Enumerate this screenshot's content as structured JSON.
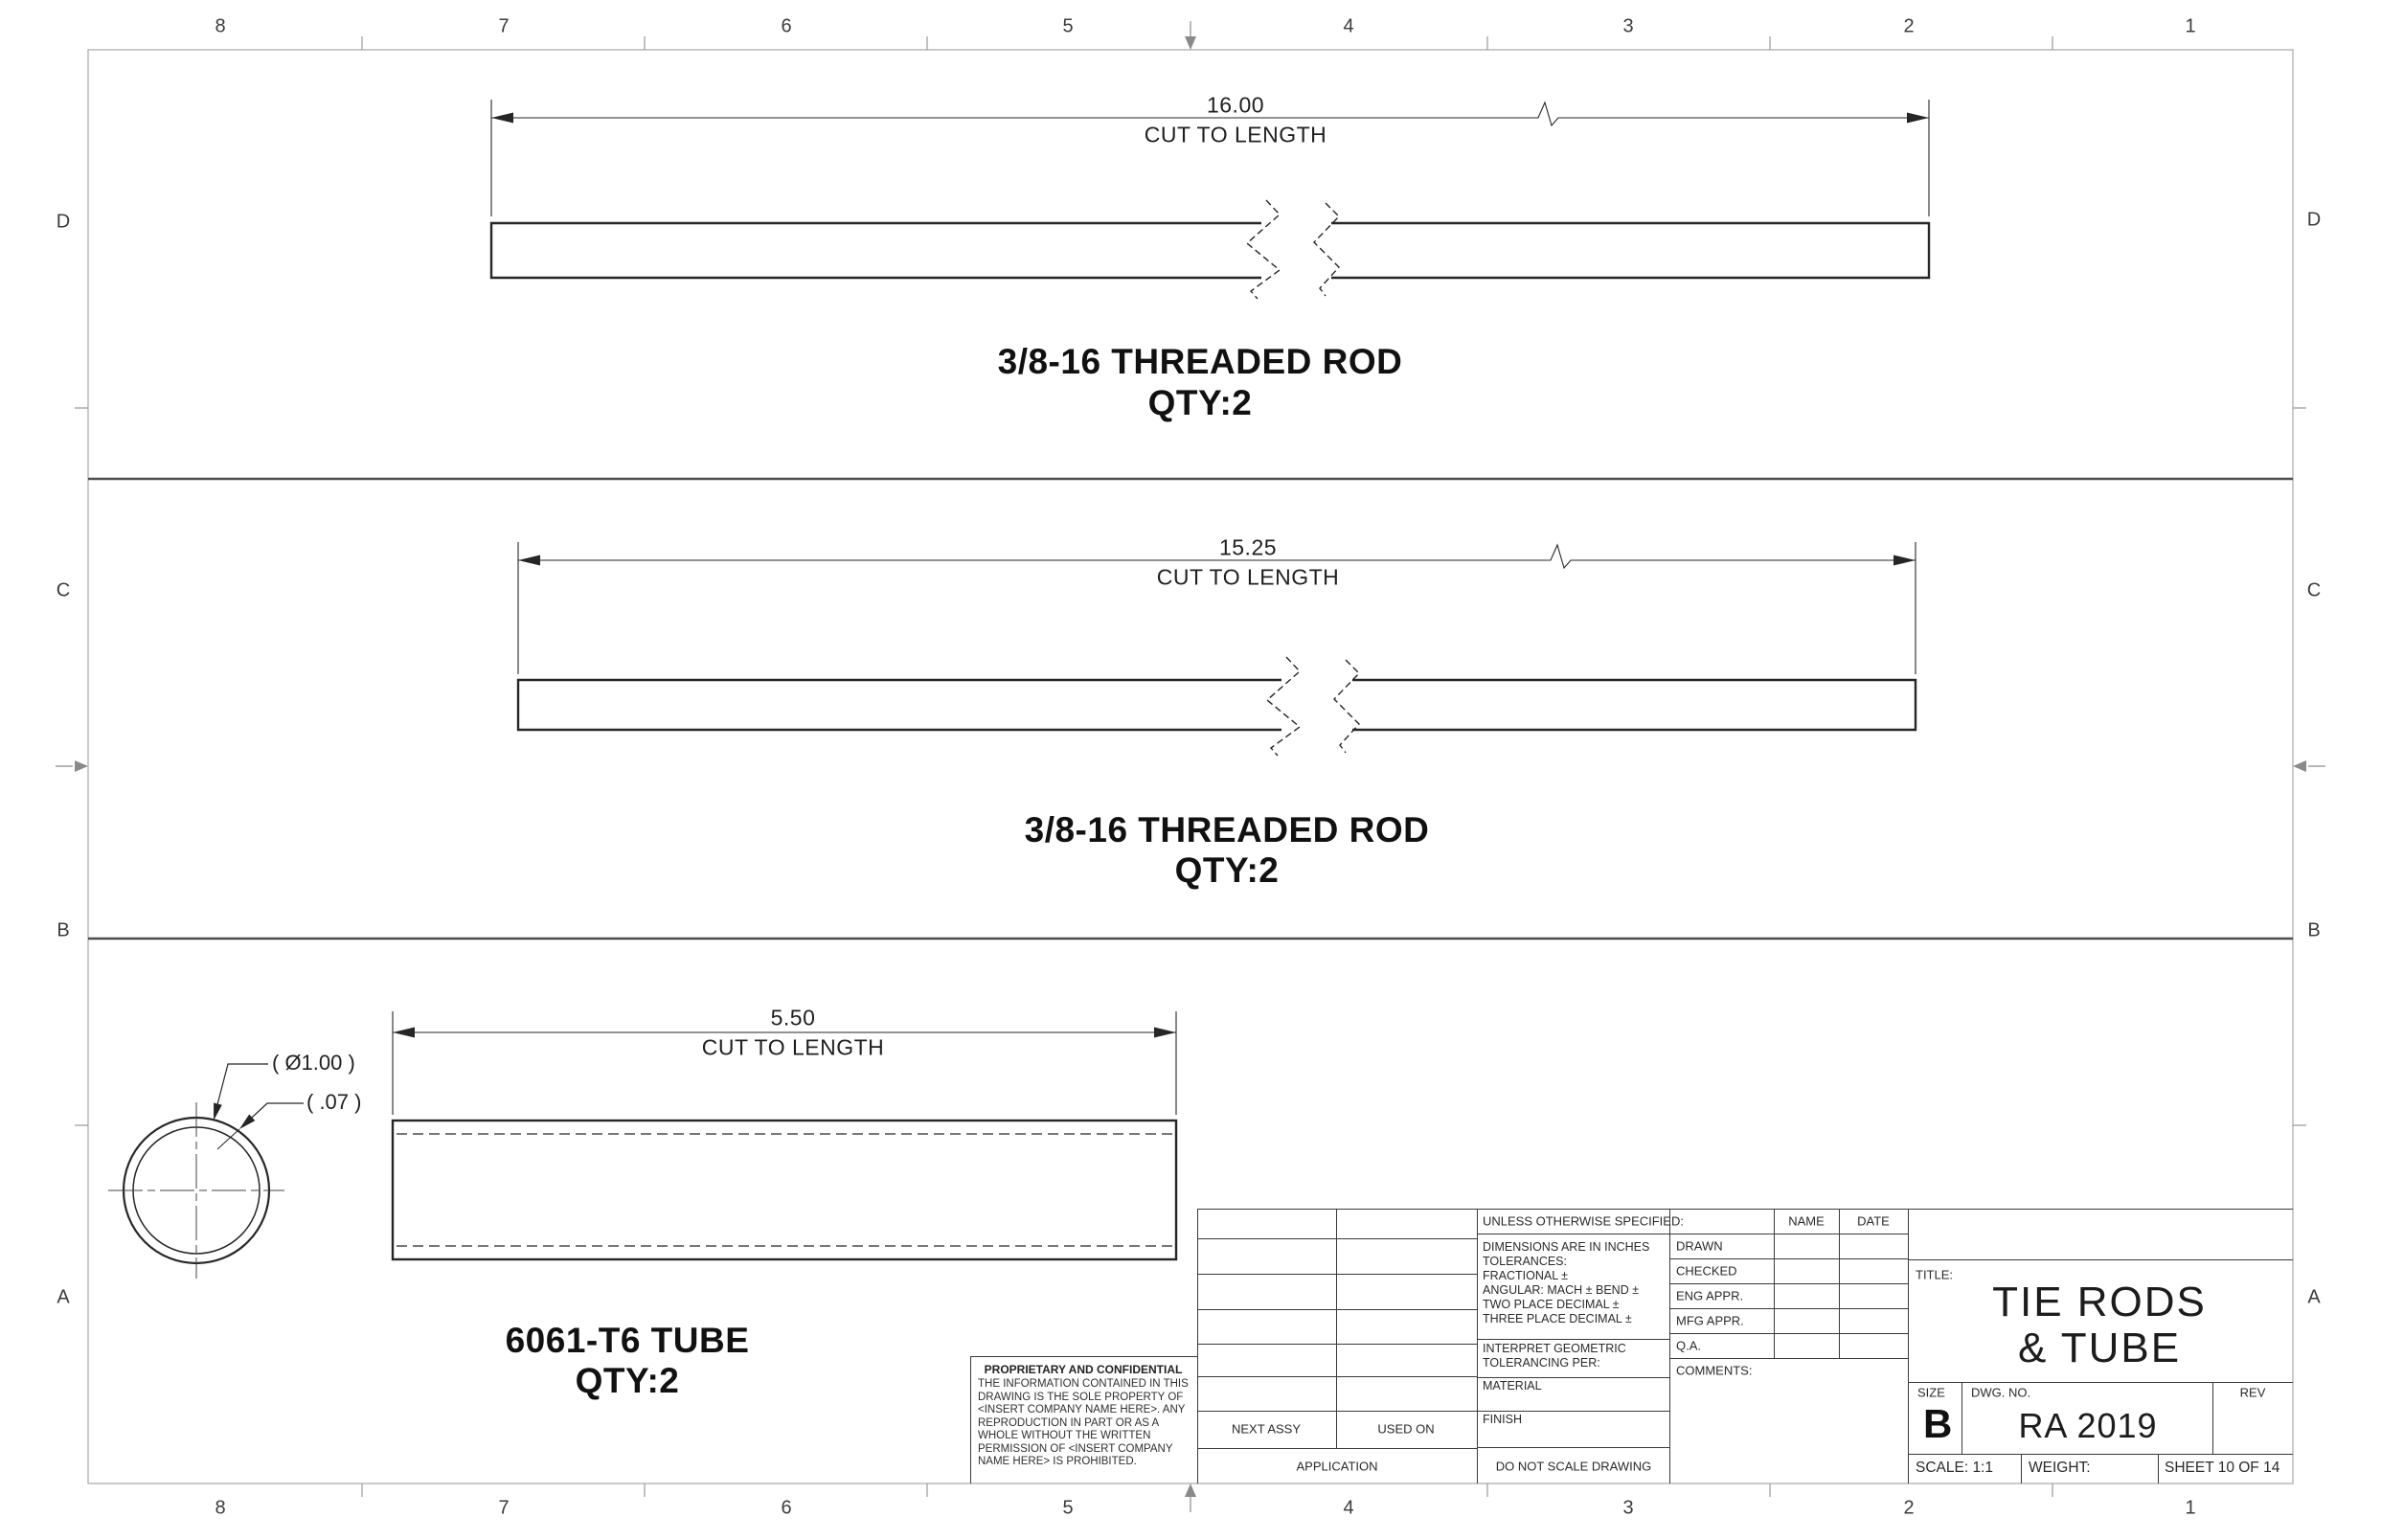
{
  "sheet": {
    "zones_top": [
      "8",
      "7",
      "6",
      "5",
      "4",
      "3",
      "2",
      "1"
    ],
    "zones_bottom": [
      "8",
      "7",
      "6",
      "5",
      "4",
      "3",
      "2",
      "1"
    ],
    "zones_left": [
      "D",
      "C",
      "B",
      "A"
    ],
    "zones_right": [
      "D",
      "C",
      "B",
      "A"
    ],
    "line_color": "#2a2a2a",
    "frame_color": "#a8a8a8"
  },
  "views": {
    "rod1": {
      "dim_value": "16.00",
      "dim_note": "CUT TO LENGTH",
      "label": "3/8-16 THREADED ROD",
      "qty": "QTY:2"
    },
    "rod2": {
      "dim_value": "15.25",
      "dim_note": "CUT TO LENGTH",
      "label": "3/8-16 THREADED ROD",
      "qty": "QTY:2"
    },
    "tube": {
      "dim_value": "5.50",
      "dim_note": "CUT TO LENGTH",
      "label": "6061-T6 TUBE",
      "qty": "QTY:2",
      "diameter_callout": "( Ø1.00 )",
      "wall_callout": "( .07 )"
    }
  },
  "title_block": {
    "tolerance_block": {
      "header": "UNLESS OTHERWISE SPECIFIED:",
      "lines": [
        "DIMENSIONS ARE IN INCHES",
        "TOLERANCES:",
        "FRACTIONAL ±",
        "ANGULAR: MACH ±    BEND ±",
        "TWO PLACE DECIMAL     ±",
        "THREE PLACE DECIMAL   ±"
      ],
      "interpret_line1": "INTERPRET GEOMETRIC",
      "interpret_line2": "TOLERANCING PER:",
      "material_label": "MATERIAL",
      "finish_label": "FINISH",
      "do_not_scale": "DO NOT SCALE DRAWING"
    },
    "approval": {
      "name_header": "NAME",
      "date_header": "DATE",
      "rows": [
        "DRAWN",
        "CHECKED",
        "ENG APPR.",
        "MFG APPR.",
        "Q.A."
      ],
      "comments_label": "COMMENTS:"
    },
    "application": {
      "next_assy": "NEXT ASSY",
      "used_on": "USED ON",
      "application_label": "APPLICATION"
    },
    "proprietary": {
      "title": "PROPRIETARY AND CONFIDENTIAL",
      "body": "THE INFORMATION CONTAINED IN THIS DRAWING IS THE SOLE PROPERTY OF <INSERT COMPANY NAME HERE>.  ANY REPRODUCTION IN PART OR AS A WHOLE WITHOUT THE WRITTEN PERMISSION OF <INSERT COMPANY NAME HERE> IS PROHIBITED."
    },
    "title_label": "TITLE:",
    "title_line1": "TIE RODS",
    "title_line2": "& TUBE",
    "size_label": "SIZE",
    "size_value": "B",
    "dwg_label": "DWG.  NO.",
    "dwg_value": "RA 2019",
    "rev_label": "REV",
    "scale_text": "SCALE: 1:1",
    "weight_label": "WEIGHT:",
    "sheet_text": "SHEET 10 OF 14"
  }
}
